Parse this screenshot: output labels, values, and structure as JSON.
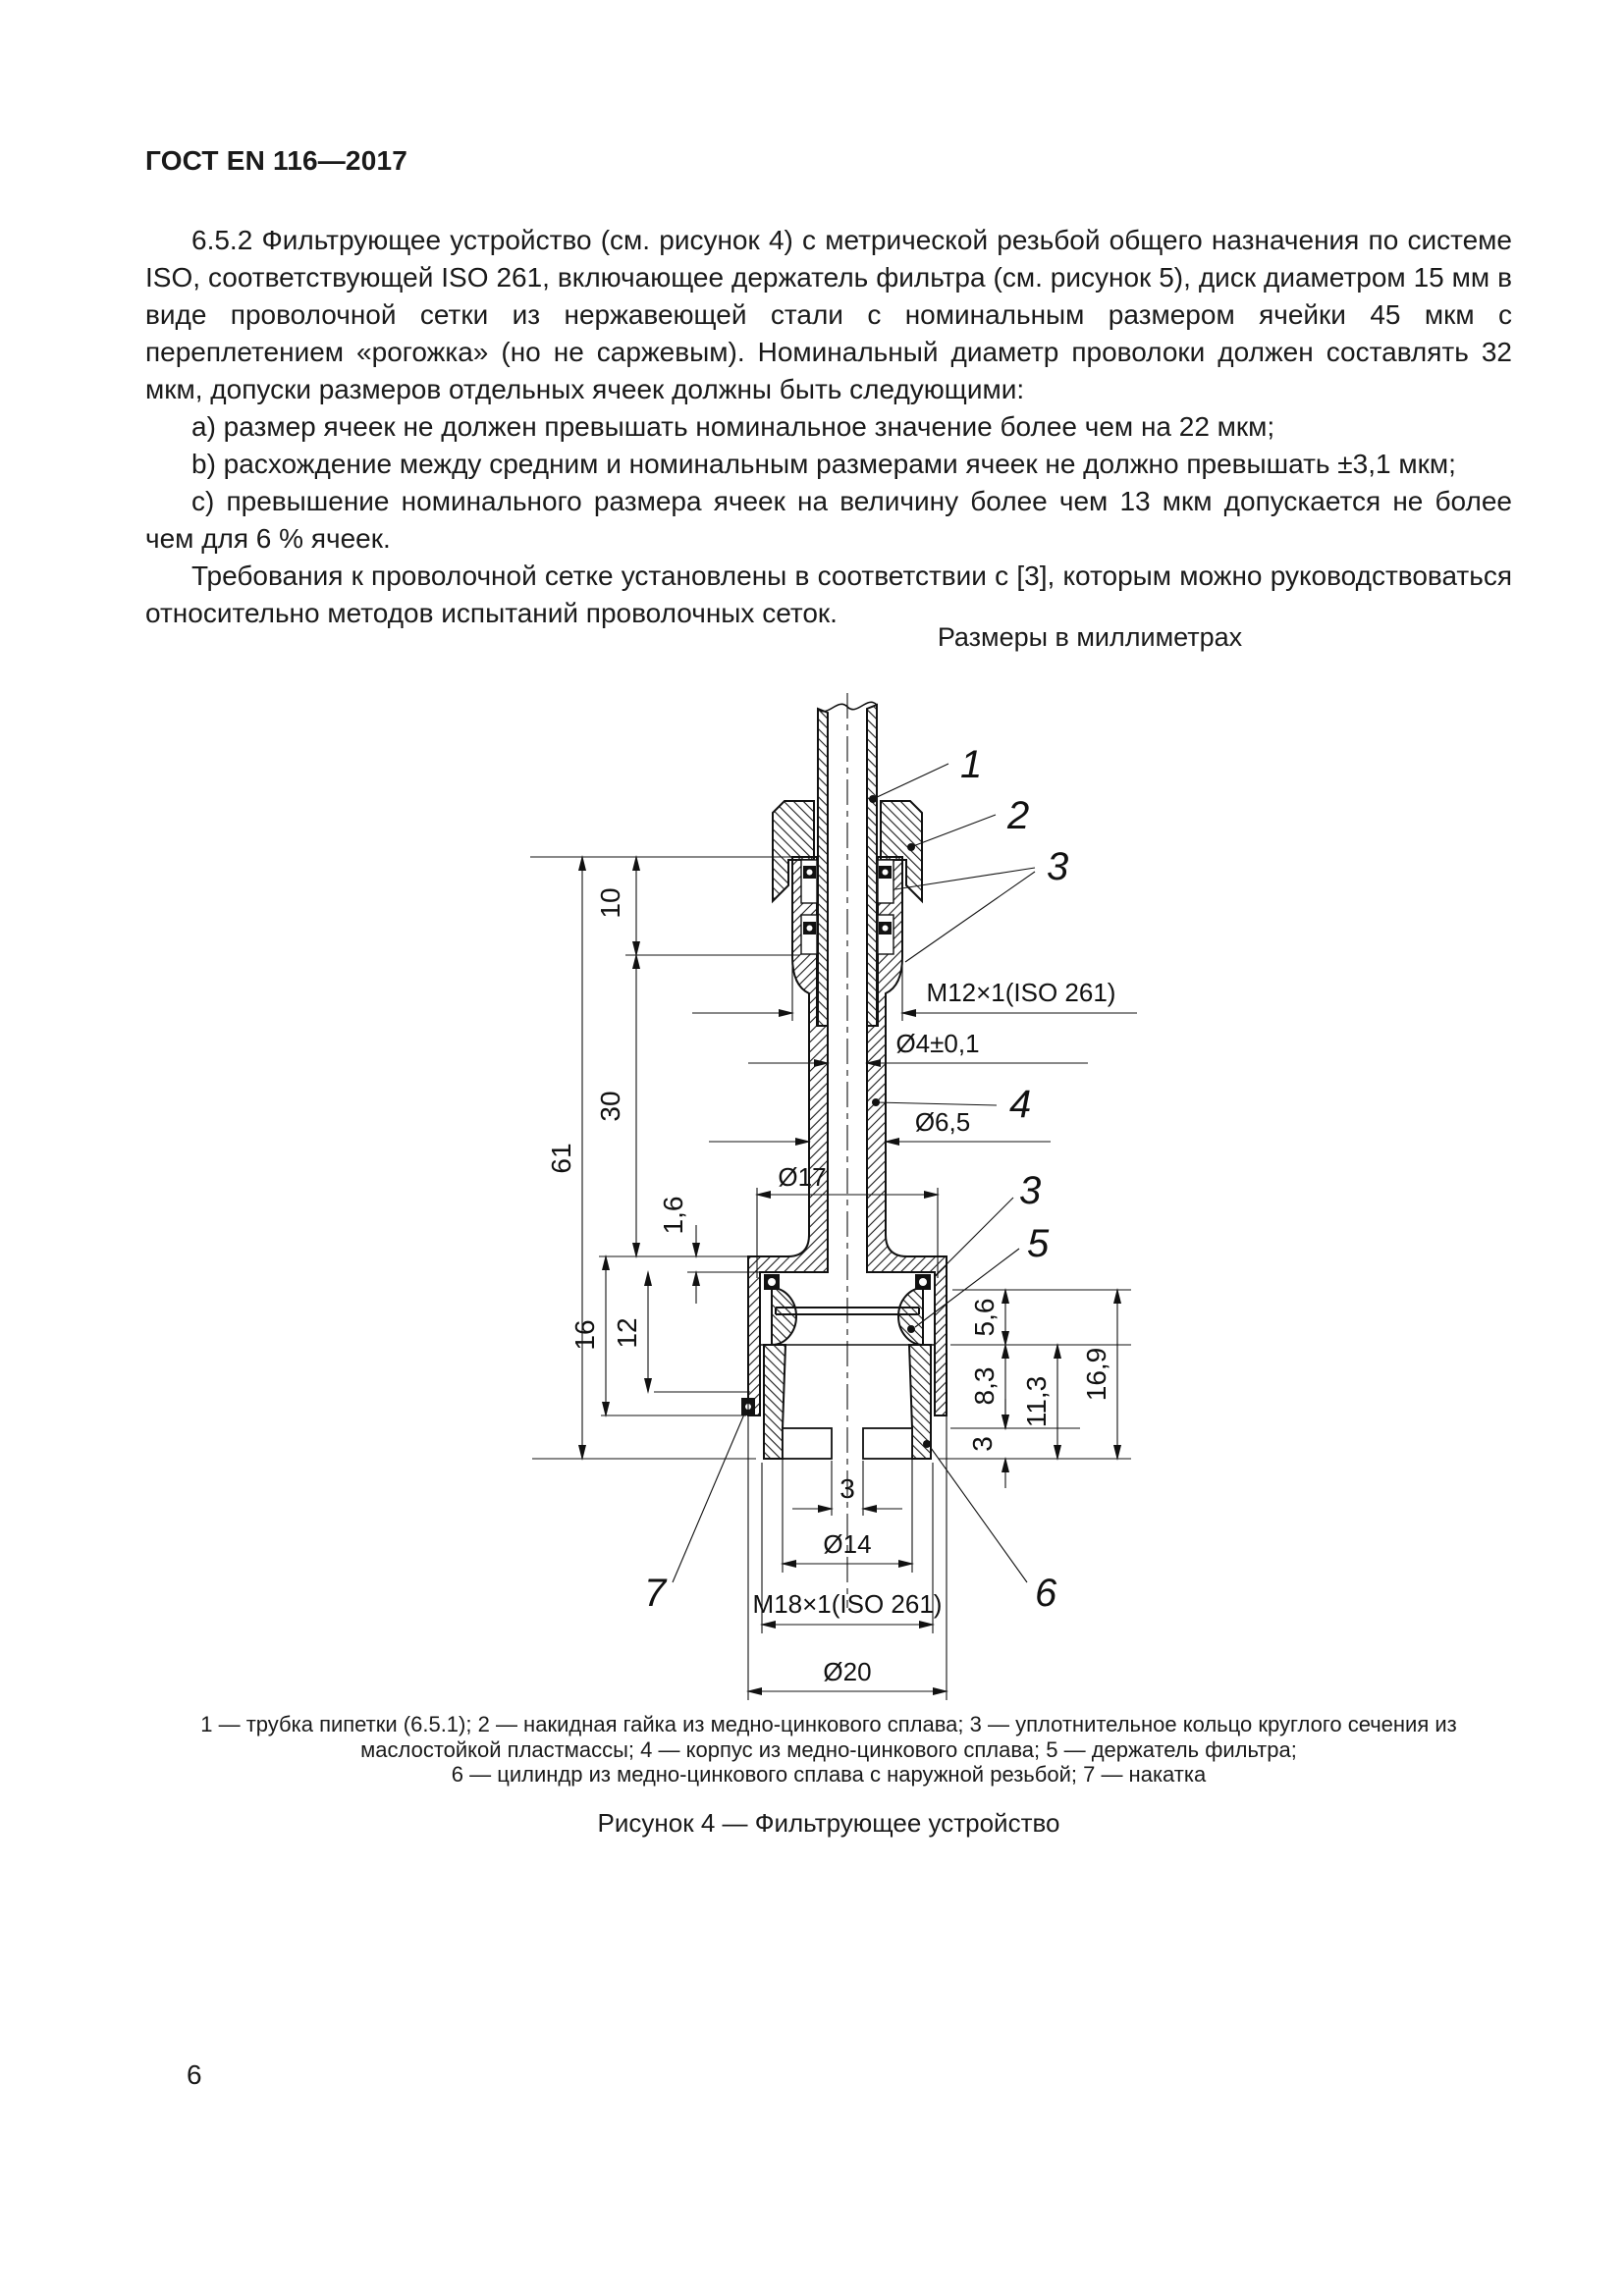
{
  "page": {
    "standard_code": "ГОСТ EN 116—2017",
    "page_number": "6"
  },
  "content": {
    "para_652": "6.5.2 Фильтрующее устройство (см. рисунок 4) с метрической резьбой общего назначения по системе ISO, соответствующей ISO 261, включающее держатель фильтра (см. рисунок 5), диск диаметром 15 мм в виде проволочной сетки из нержавеющей стали с номинальным размером ячейки 45 мкм с переплетением «рогожка» (но не саржевым). Номинальный диаметр проволоки должен составлять 32 мкм, допуски размеров отдельных ячеек должны быть следующими:",
    "item_a": "а) размер ячеек не должен превышать номинальное значение более чем на 22 мкм;",
    "item_b": "b) расхождение между средним и номинальным размерами ячеек не должно превышать ±3,1 мкм;",
    "item_c": "c) превышение номинального размера ячеек на величину более чем 13 мкм допускается не более чем для 6 % ячеек.",
    "para_mesh": "Требования к проволочной сетке установлены в соответствии с [3], которым можно руководствоваться относительно методов испытаний проволочных сеток."
  },
  "figure": {
    "units_note": "Размеры в миллиметрах",
    "dims": {
      "overall_height": "61",
      "top_section": "10",
      "middle_section": "30",
      "flange_lip": "1,6",
      "lower_section": "16",
      "inner_depth": "12",
      "holder_height": "5,6",
      "cavity_depth": "8,3",
      "bottom_wall": "3",
      "lower_inner": "11,3",
      "lower_total": "16,9",
      "thread_top": "M12×1(ISO 261)",
      "bore": "Ø4±0,1",
      "body_dia": "Ø6,5",
      "groove_dia": "Ø17",
      "slot_width": "3",
      "cavity_dia": "Ø14",
      "thread_bottom": "M18×1(ISO 261)",
      "outer_dia": "Ø20"
    },
    "callouts": {
      "tube": "1",
      "nut": "2",
      "oring_top": "3",
      "body": "4",
      "oring_bottom": "3",
      "holder": "5",
      "cylinder": "6",
      "knurl": "7"
    },
    "caption_line1": "1 — трубка пипетки (6.5.1); 2 — накидная гайка из медно-цинкового сплава; 3 — уплотнительное кольцо круглого сечения из",
    "caption_line2": "маслостойкой пластмассы; 4 — корпус из медно-цинкового сплава; 5 — держатель фильтра;",
    "caption_line3": "6 — цилиндр из медно-цинкового сплава с наружной резьбой; 7 — накатка",
    "figure_label": "Рисунок 4 — Фильтрующее устройство"
  }
}
